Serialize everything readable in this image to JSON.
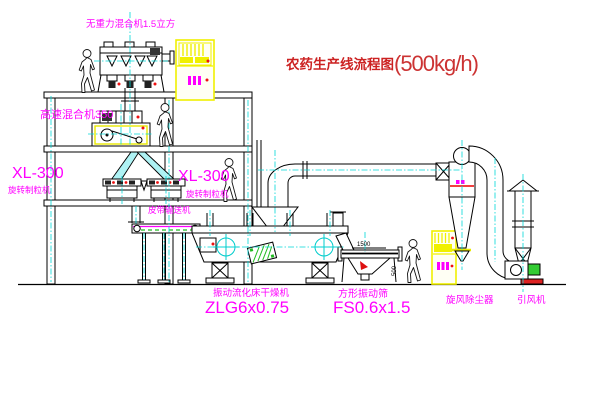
{
  "title": {
    "text": "农药生产线流程图",
    "capacity": "(500kg/h)"
  },
  "equipment_labels": {
    "gravity_mixer": "无重力混合机1.5立方",
    "high_speed_mixer": "高速混合机350",
    "granulator_left_model": "XL-300",
    "granulator_left_name": "旋转制粒机",
    "granulator_right_model": "XL-300",
    "granulator_right_name": "旋转制粒机",
    "belt_conveyor": "皮带输送机",
    "dryer_name": "振动流化床干燥机",
    "dryer_model": "ZLG6x0.75",
    "sieve_name": "方形振动筛",
    "sieve_model": "FS0.6x1.5",
    "cyclone_collector": "旋风除尘器",
    "induced_draft_fan": "引风机"
  },
  "dimensions": {
    "sieve_width": "1500",
    "sieve_outlet_height": "500"
  },
  "colors": {
    "label": "#ff00ff",
    "title": "#cc2222",
    "line": "#000000",
    "centerline": "#00d8d8",
    "cabinet": "#f0f000",
    "accent_red": "#ee1111",
    "accent_green": "#22bb22"
  }
}
